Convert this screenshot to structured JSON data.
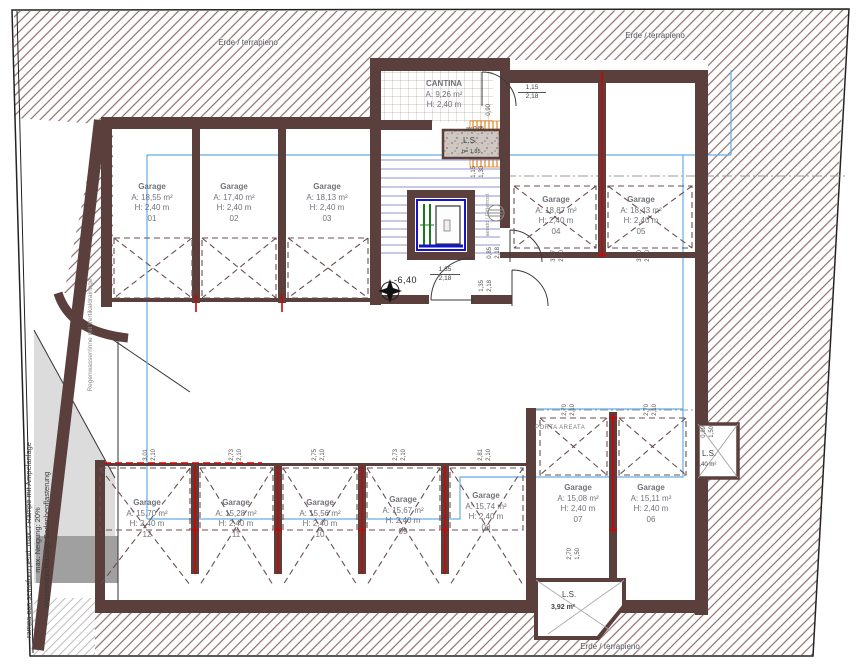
{
  "earth_label": "Erde / terrapieno",
  "cantina": {
    "name": "CANTINA",
    "area": "A: 9,26 m²",
    "height": "H: 2,40 m"
  },
  "garages": [
    {
      "label": "Garage",
      "area": "A: 18,55 m²",
      "height": "H: 2,40 m",
      "num": "01"
    },
    {
      "label": "Garage",
      "area": "A: 17,40 m²",
      "height": "H: 2,40 m",
      "num": "02"
    },
    {
      "label": "Garage",
      "area": "A: 18,13 m²",
      "height": "H: 2,40 m",
      "num": "03"
    },
    {
      "label": "Garage",
      "area": "A: 18,87 m²",
      "height": "H: 2,40 m",
      "num": "04"
    },
    {
      "label": "Garage",
      "area": "A: 18,43 m²",
      "height": "H: 2,40 m",
      "num": "05"
    },
    {
      "label": "Garage",
      "area": "A: 15,11 m²",
      "height": "H: 2,40 m",
      "num": "06"
    },
    {
      "label": "Garage",
      "area": "A: 15,08 m²",
      "height": "H: 2,40 m",
      "num": "07"
    },
    {
      "label": "Garage",
      "area": "A: 15,74 m²",
      "height": "H: 2,40 m",
      "num": "08"
    },
    {
      "label": "Garage",
      "area": "A: 15,67 m²",
      "height": "H: 2,40 m",
      "num": "09"
    },
    {
      "label": "Garage",
      "area": "A: 15,56 m²",
      "height": "H: 2,40 m",
      "num": "10"
    },
    {
      "label": "Garage",
      "area": "A: 15,28 m²",
      "height": "H: 2,40 m",
      "num": "11"
    },
    {
      "label": "Garage",
      "area": "A: 15,70 m²",
      "height": "H: 2,40 m",
      "num": "12"
    }
  ],
  "porta_areata": "PORTA AREATA",
  "level_marker": "-6,40",
  "ls_cantina": {
    "top": "av 0,85",
    "name": "L.S.",
    "bottom": "b= 1,35"
  },
  "ls_right": {
    "name": "L.S.",
    "area": "1,40 m²",
    "dims": [
      "0,89",
      "1,50"
    ]
  },
  "ls_bottom": {
    "name": "L.S.",
    "area": "3,92 m²",
    "dims": [
      "2,70",
      "1,50"
    ]
  },
  "dims": {
    "cantina_door": [
      "1,15",
      "2,18"
    ],
    "door_height_small": "0,90",
    "stair_top": [
      "1,15",
      "1,30"
    ],
    "lobby_door": [
      "1,35",
      "2,18"
    ],
    "side_door_a": [
      "0,85",
      "2,18"
    ],
    "side_door_b": [
      "1,35",
      "2,18"
    ],
    "stalls_top_right": [
      [
        "3,07",
        "2,10"
      ],
      [
        "3,10",
        "2,10"
      ]
    ],
    "stalls_porta": [
      [
        "2,70",
        "2,10"
      ],
      [
        "2,70",
        "2,10"
      ]
    ],
    "stalls_bottom": [
      [
        "3,01",
        "2,10"
      ],
      [
        "2,73",
        "2,10"
      ],
      [
        "2,75",
        "2,10"
      ],
      [
        "2,73",
        "2,10"
      ],
      [
        "2,81",
        "2,10"
      ]
    ]
  },
  "notes": {
    "ramp_line1": "rampa con semaforo pend. max. / Rampe mit Ampelanlage",
    "ramp_line2": "max. Neigung: 20%",
    "ramp_line3": "Wasserdurchlässige Bodenbepflasterung",
    "drainage": "Regenwasserrinne mit Vertikaldrainage",
    "vent": "aerato / Gitterrost"
  },
  "colors": {
    "wall": "#5a3f3c",
    "hatch": "#8f6f6b",
    "blue_overlay": "#63aee6",
    "stair_blue": "#9090d0",
    "red": "#d40000",
    "orange": "#e8821e"
  }
}
